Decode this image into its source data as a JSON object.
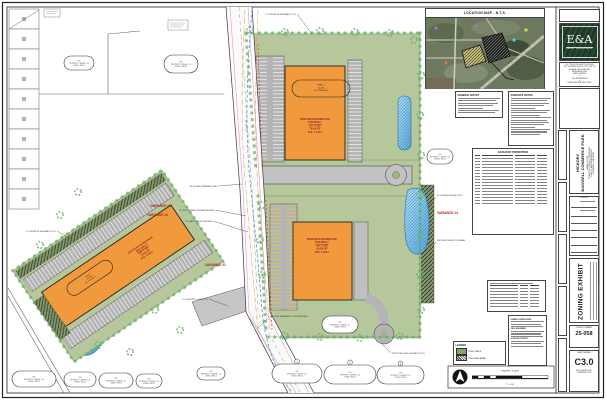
{
  "colors": {
    "building_fill": "#F09A3D",
    "open_space": "#B7C79C",
    "pond": "#58A7DD",
    "tree_line": "#69B469",
    "variance_label": "#B22215",
    "logo_bg": "#24402E"
  },
  "location_map": {
    "title": "LOCATION MAP - N.T.S."
  },
  "firm": {
    "logo_text": "E&A",
    "name": "EBERLY & ASSOCIATES",
    "contact_lines": [
      "TEL 770.452.7849  FAX 770.452.3086",
      "2951 FLOWERS ROAD SOUTH, STE 119",
      "ATLANTA, GEORGIA 30341",
      "WWW.EBERLY.NET"
    ],
    "services": [
      "LAND PLANNING",
      "CIVIL ENGINEERING",
      "LANDSCAPE ARCHITECTURE"
    ],
    "separator": "▼"
  },
  "notes": {
    "general_title": "GENERAL NOTES",
    "variance_title": "VARIANCE NOTES"
  },
  "tables": {
    "adjacent_title": "ADJACENT PROPERTIES"
  },
  "legend": {
    "title": "LEGEND",
    "open_space": "OPEN SPACE",
    "tree_save": "TREE SAVE AREA"
  },
  "site_data": {
    "owner": "OWNER / DEVELOPER:",
    "engineer": "CIVIL ENGINEER:",
    "contact": "24 HOUR CONTACT:"
  },
  "scalebar": {
    "label": "GRAPHIC SCALE",
    "ratio": "1\" = 100'"
  },
  "plan": {
    "variances": [
      "VARIANCE #1",
      "VARIANCE #2",
      "VARIANCE #3",
      "VARIANCE #4"
    ],
    "buildings": {
      "b1": {
        "lines": [
          "PROPOSED WAREHOUSE",
          "BUILDING 1",
          "210' X 360'",
          "75,600 SF",
          "FFE: 1,100.0"
        ]
      },
      "b2": {
        "lines": [
          "PROPOSED WAREHOUSE",
          "BUILDING 2",
          "200' X 330'",
          "66,000 SF",
          "FFE: 1,094.0"
        ]
      },
      "b3": {
        "lines": [
          "PROPOSED WAREHOUSE",
          "BUILDING 3",
          "180' X 420'",
          "75,600 SF",
          "FFE: 1,088.0"
        ]
      }
    },
    "parcel_oval": {
      "lines": [
        "TRACT 1",
        "±12.4 AC",
        "EX. ZONING: A1"
      ]
    },
    "owner_oval": {
      "lines": [
        "N/F",
        "PROPERTY OWNER, LLC",
        "ZONED: RES-3"
      ]
    },
    "callouts": {
      "c1": "PROPOSED RETAINING WALL",
      "c2": "50' UNDISTURBED STREAM BUFFER",
      "c3": "25' STATE WATERS BUFFER",
      "c4": "EXISTING PAVEMENT TO BE REMOVED",
      "c5": "6\" CONCRETE SIDEWALK (TYP.)",
      "c6": "20' ZONING BUFFER (TYP.)",
      "c7": "EXISTING TREES TO REMAIN",
      "c8": "6\" CONCRETE CURB (TYP.)",
      "c9": "5' CONCRETE SIDEWALK (TYP.)",
      "c10": "PROPOSED FIRE HYDRANT (TYP.)",
      "road": "EX. 60' R/W"
    }
  },
  "title_block": {
    "project_name_line1": "HICKORY",
    "project_name_line2": "BAGWELL COMMERCE PARK",
    "address_lines": [
      "LAND LOT 84",
      "FORSYTH COUNTY, GEORGIA",
      "HWY 9 / BROOKWOOD RD",
      "CUMMING, GA 30040"
    ],
    "revisions_label": "REVISIONS",
    "sheet_title": "ZONING EXHIBIT",
    "project_number_label": "PROJECT NUMBER",
    "project_number": "25-058",
    "sheet_number_label": "SHEET NUMBER",
    "sheet_number": "C3.0",
    "issue_note_1": "NOT ISSUED FOR",
    "issue_note_2": "CONSTRUCTION",
    "copyright": "© 2025 EBERLY & ASSOCIATES, INC. ALL RIGHTS RESERVED"
  }
}
